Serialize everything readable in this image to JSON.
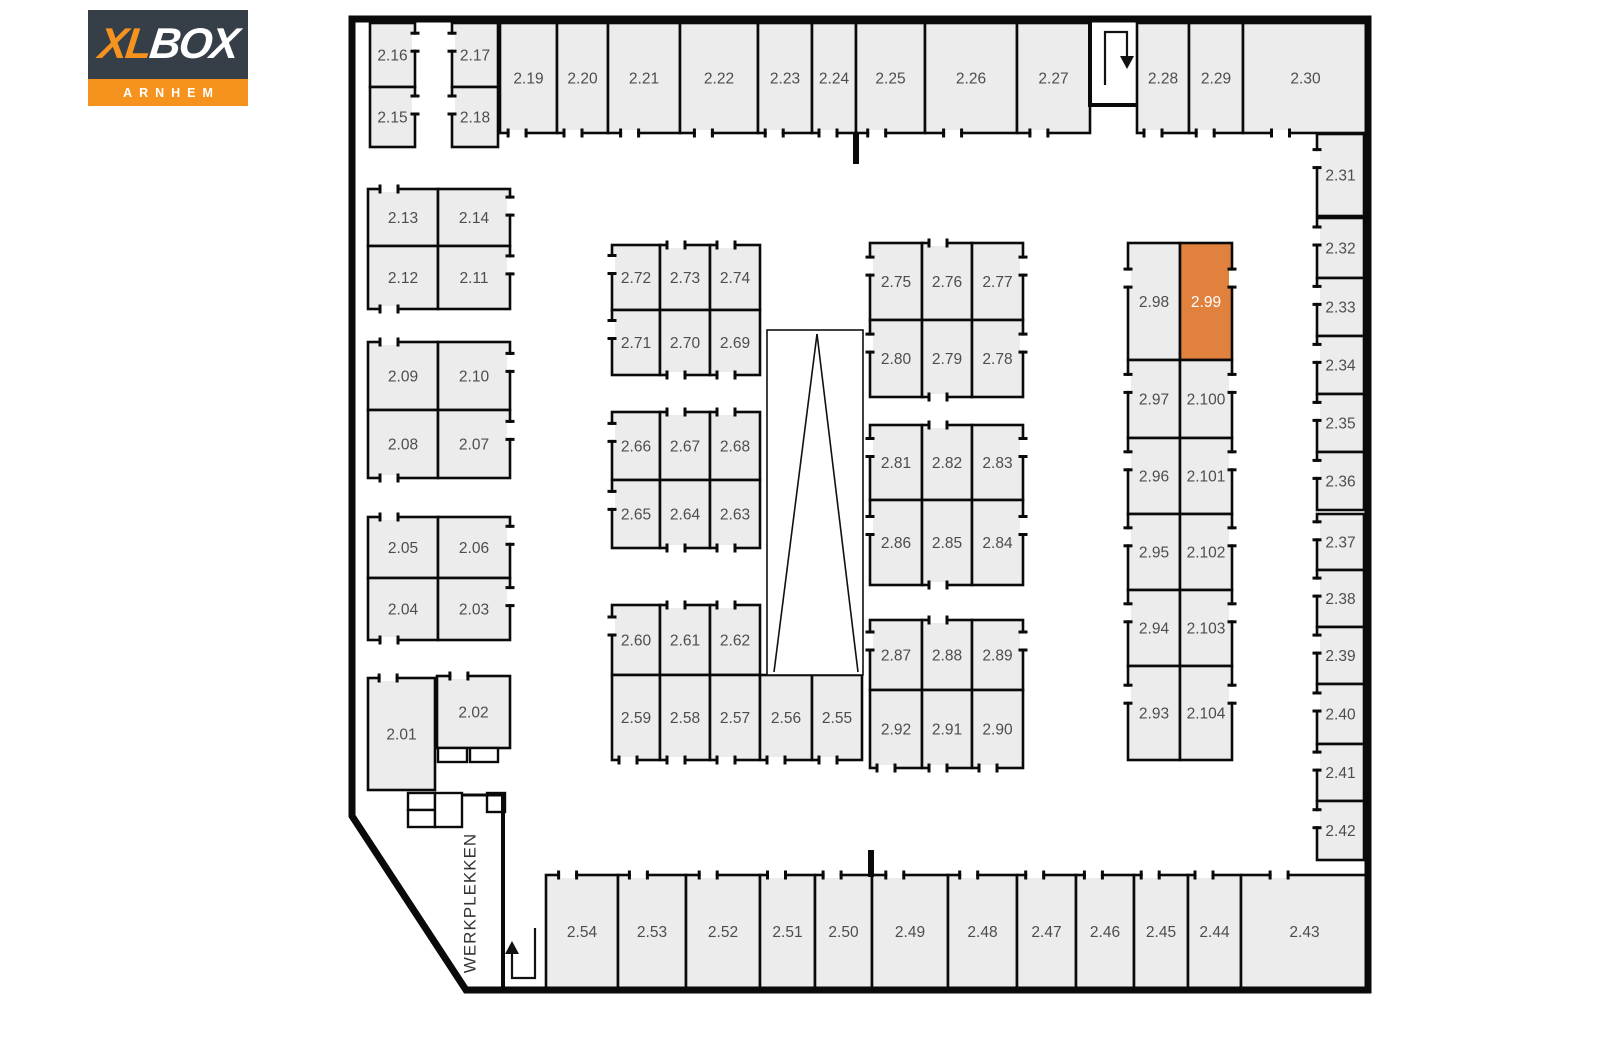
{
  "logo": {
    "brand_xl": "XL",
    "brand_box": "BOX",
    "subtitle": "ARNHEM",
    "bg_color": "#363E48",
    "orange": "#F6921E",
    "xl_color": "#F6921E",
    "box_color": "#FFFFFF"
  },
  "floorplan": {
    "selected_unit": "2.99",
    "area_label": {
      "text": "WERKPLEKKEN",
      "x": 470,
      "y": 903,
      "rotation": -90
    },
    "colors": {
      "unit_fill": "#ECECEC",
      "wall": "#0A0A0A",
      "unit_label": "#4D4D4D",
      "highlight_fill": "#E0813E",
      "highlight_label": "#FFFFFF",
      "arrow": "#111111",
      "area_label_color": "#333333"
    },
    "units": [
      [
        "2.16",
        370,
        23,
        45,
        64,
        "r"
      ],
      [
        "2.15",
        370,
        87,
        45,
        60,
        "r"
      ],
      [
        "2.17",
        452,
        23,
        46,
        64,
        "l"
      ],
      [
        "2.18",
        452,
        87,
        46,
        60,
        "l"
      ],
      [
        "2.19",
        500,
        23,
        57,
        110,
        "b"
      ],
      [
        "2.20",
        557,
        23,
        51,
        110,
        "b"
      ],
      [
        "2.21",
        608,
        23,
        72,
        110,
        "b"
      ],
      [
        "2.22",
        680,
        23,
        78,
        110,
        "b"
      ],
      [
        "2.23",
        758,
        23,
        54,
        110,
        "b"
      ],
      [
        "2.24",
        812,
        23,
        44,
        110,
        "b"
      ],
      [
        "2.25",
        856,
        23,
        69,
        110,
        "b"
      ],
      [
        "2.26",
        925,
        23,
        92,
        110,
        "b"
      ],
      [
        "2.27",
        1017,
        23,
        73,
        110,
        "b"
      ],
      [
        "2.28",
        1137,
        23,
        52,
        110,
        "b"
      ],
      [
        "2.29",
        1189,
        23,
        54,
        110,
        "b"
      ],
      [
        "2.30",
        1243,
        23,
        125,
        110,
        "b"
      ],
      [
        "2.13",
        368,
        189,
        70,
        57,
        "t"
      ],
      [
        "2.14",
        438,
        189,
        72,
        57,
        "r"
      ],
      [
        "2.12",
        368,
        246,
        70,
        63,
        "b"
      ],
      [
        "2.11",
        438,
        246,
        72,
        63,
        "r"
      ],
      [
        "2.09",
        368,
        342,
        70,
        68,
        "t"
      ],
      [
        "2.10",
        438,
        342,
        72,
        68,
        "r"
      ],
      [
        "2.08",
        368,
        410,
        70,
        68,
        "b"
      ],
      [
        "2.07",
        438,
        410,
        72,
        68,
        "r"
      ],
      [
        "2.05",
        368,
        517,
        70,
        61,
        "t"
      ],
      [
        "2.06",
        438,
        517,
        72,
        61,
        "r"
      ],
      [
        "2.04",
        368,
        578,
        70,
        62,
        "b"
      ],
      [
        "2.03",
        438,
        578,
        72,
        62,
        "r"
      ],
      [
        "2.01",
        368,
        678,
        67,
        112,
        "t"
      ],
      [
        "2.02",
        437,
        676,
        73,
        72,
        "t"
      ],
      [
        "2.72",
        612,
        245,
        48,
        65,
        "l"
      ],
      [
        "2.73",
        660,
        245,
        50,
        65,
        "t"
      ],
      [
        "2.74",
        710,
        245,
        50,
        65,
        "t"
      ],
      [
        "2.71",
        612,
        310,
        48,
        65,
        "l"
      ],
      [
        "2.70",
        660,
        310,
        50,
        65,
        "b"
      ],
      [
        "2.69",
        710,
        310,
        50,
        65,
        "b"
      ],
      [
        "2.66",
        612,
        412,
        48,
        68,
        "l"
      ],
      [
        "2.67",
        660,
        412,
        50,
        68,
        "t"
      ],
      [
        "2.68",
        710,
        412,
        50,
        68,
        "t"
      ],
      [
        "2.65",
        612,
        480,
        48,
        68,
        "l"
      ],
      [
        "2.64",
        660,
        480,
        50,
        68,
        "b"
      ],
      [
        "2.63",
        710,
        480,
        50,
        68,
        "b"
      ],
      [
        "2.60",
        612,
        605,
        48,
        70,
        "l"
      ],
      [
        "2.61",
        660,
        605,
        50,
        70,
        "t"
      ],
      [
        "2.62",
        710,
        605,
        50,
        70,
        "t"
      ],
      [
        "2.59",
        612,
        675,
        48,
        85,
        "b"
      ],
      [
        "2.58",
        660,
        675,
        50,
        85,
        "b"
      ],
      [
        "2.57",
        710,
        675,
        50,
        85,
        "b"
      ],
      [
        "2.56",
        760,
        675,
        52,
        85,
        "b"
      ],
      [
        "2.55",
        812,
        675,
        50,
        85,
        "b"
      ],
      [
        "2.75",
        870,
        243,
        52,
        77,
        "l"
      ],
      [
        "2.76",
        922,
        243,
        50,
        77,
        "t"
      ],
      [
        "2.77",
        972,
        243,
        51,
        77,
        "r"
      ],
      [
        "2.80",
        870,
        320,
        52,
        77,
        "l"
      ],
      [
        "2.79",
        922,
        320,
        50,
        77,
        "b"
      ],
      [
        "2.78",
        972,
        320,
        51,
        77,
        "r"
      ],
      [
        "2.81",
        870,
        425,
        52,
        75,
        "l"
      ],
      [
        "2.82",
        922,
        425,
        50,
        75,
        "t"
      ],
      [
        "2.83",
        972,
        425,
        51,
        75,
        "r"
      ],
      [
        "2.86",
        870,
        500,
        52,
        85,
        "l"
      ],
      [
        "2.85",
        922,
        500,
        50,
        85,
        "b"
      ],
      [
        "2.84",
        972,
        500,
        51,
        85,
        "r"
      ],
      [
        "2.87",
        870,
        620,
        52,
        70,
        "l"
      ],
      [
        "2.88",
        922,
        620,
        50,
        70,
        "t"
      ],
      [
        "2.89",
        972,
        620,
        51,
        70,
        "r"
      ],
      [
        "2.92",
        870,
        690,
        52,
        78,
        "b"
      ],
      [
        "2.91",
        922,
        690,
        50,
        78,
        "b"
      ],
      [
        "2.90",
        972,
        690,
        51,
        78,
        "b"
      ],
      [
        "2.98",
        1128,
        243,
        52,
        117,
        "l"
      ],
      [
        "2.99",
        1180,
        243,
        52,
        117,
        "r"
      ],
      [
        "2.97",
        1128,
        360,
        52,
        78,
        "l"
      ],
      [
        "2.100",
        1180,
        360,
        52,
        78,
        "r"
      ],
      [
        "2.96",
        1128,
        438,
        52,
        76,
        "l"
      ],
      [
        "2.101",
        1180,
        438,
        52,
        76,
        "r"
      ],
      [
        "2.95",
        1128,
        514,
        52,
        76,
        "l"
      ],
      [
        "2.102",
        1180,
        514,
        52,
        76,
        "r"
      ],
      [
        "2.94",
        1128,
        590,
        52,
        76,
        "l"
      ],
      [
        "2.103",
        1180,
        590,
        52,
        76,
        "r"
      ],
      [
        "2.93",
        1128,
        666,
        52,
        94,
        "l"
      ],
      [
        "2.104",
        1180,
        666,
        52,
        94,
        "r"
      ],
      [
        "2.31",
        1317,
        134,
        47,
        82,
        "l"
      ],
      [
        "2.32",
        1317,
        218,
        47,
        60,
        "l"
      ],
      [
        "2.33",
        1317,
        278,
        47,
        58,
        "l"
      ],
      [
        "2.34",
        1317,
        336,
        47,
        58,
        "l"
      ],
      [
        "2.35",
        1317,
        394,
        47,
        58,
        "l"
      ],
      [
        "2.36",
        1317,
        452,
        47,
        58,
        "l"
      ],
      [
        "2.37",
        1317,
        514,
        47,
        56,
        "l"
      ],
      [
        "2.38",
        1317,
        570,
        47,
        57,
        "l"
      ],
      [
        "2.39",
        1317,
        627,
        47,
        57,
        "l"
      ],
      [
        "2.40",
        1317,
        684,
        47,
        60,
        "l"
      ],
      [
        "2.41",
        1317,
        744,
        47,
        57,
        "l"
      ],
      [
        "2.42",
        1317,
        801,
        47,
        59,
        "l"
      ],
      [
        "2.54",
        546,
        875,
        72,
        113,
        "t"
      ],
      [
        "2.53",
        618,
        875,
        68,
        113,
        "t"
      ],
      [
        "2.52",
        686,
        875,
        74,
        113,
        "t"
      ],
      [
        "2.51",
        760,
        875,
        55,
        113,
        "t"
      ],
      [
        "2.50",
        815,
        875,
        57,
        113,
        "t"
      ],
      [
        "2.49",
        872,
        875,
        76,
        113,
        "t"
      ],
      [
        "2.48",
        948,
        875,
        69,
        113,
        "t"
      ],
      [
        "2.47",
        1017,
        875,
        59,
        113,
        "t"
      ],
      [
        "2.46",
        1076,
        875,
        58,
        113,
        "t"
      ],
      [
        "2.45",
        1134,
        875,
        54,
        113,
        "t"
      ],
      [
        "2.44",
        1188,
        875,
        53,
        113,
        "t"
      ],
      [
        "2.43",
        1241,
        875,
        127,
        113,
        "t"
      ]
    ],
    "walls": {
      "outer": [
        [
          352,
          19
        ],
        [
          1368,
          19
        ],
        [
          1368,
          990
        ],
        [
          466,
          990
        ],
        [
          352,
          816
        ]
      ],
      "segments": [
        {
          "pts": [
            [
              1090,
              21
            ],
            [
              1090,
              105
            ],
            [
              1137,
              105
            ]
          ],
          "w": 4
        },
        {
          "pts": [
            [
              856,
              133
            ],
            [
              856,
              164
            ]
          ],
          "w": 6
        },
        {
          "pts": [
            [
              871,
              850
            ],
            [
              871,
              877
            ]
          ],
          "w": 6
        },
        {
          "pts": [
            [
              503,
              793
            ],
            [
              503,
              990
            ]
          ],
          "w": 4
        },
        {
          "pts": [
            [
              462,
              795
            ],
            [
              503,
              795
            ]
          ],
          "w": 3
        }
      ]
    },
    "ramp": {
      "x": 767,
      "y": 330,
      "w": 96,
      "h": 345,
      "apex": [
        817,
        334
      ],
      "feet": [
        [
          774,
          672
        ],
        [
          858,
          672
        ]
      ]
    },
    "service_boxes": [
      [
        438,
        748,
        29,
        14
      ],
      [
        470,
        748,
        28,
        14
      ],
      [
        408,
        793,
        27,
        17
      ],
      [
        408,
        810,
        27,
        17
      ],
      [
        435,
        793,
        27,
        34
      ],
      [
        487,
        793,
        18,
        19
      ]
    ],
    "arrows": [
      {
        "name": "entrance-arrow-down",
        "line": [
          [
            1105,
            85
          ],
          [
            1105,
            32
          ],
          [
            1127,
            32
          ],
          [
            1127,
            57
          ]
        ],
        "head": [
          [
            1120,
            56
          ],
          [
            1134,
            56
          ],
          [
            1127,
            69
          ]
        ]
      },
      {
        "name": "entrance-arrow-up",
        "line": [
          [
            535,
            928
          ],
          [
            535,
            978
          ],
          [
            512,
            978
          ],
          [
            512,
            952
          ]
        ],
        "head": [
          [
            505,
            954
          ],
          [
            519,
            954
          ],
          [
            512,
            941
          ]
        ]
      }
    ]
  }
}
